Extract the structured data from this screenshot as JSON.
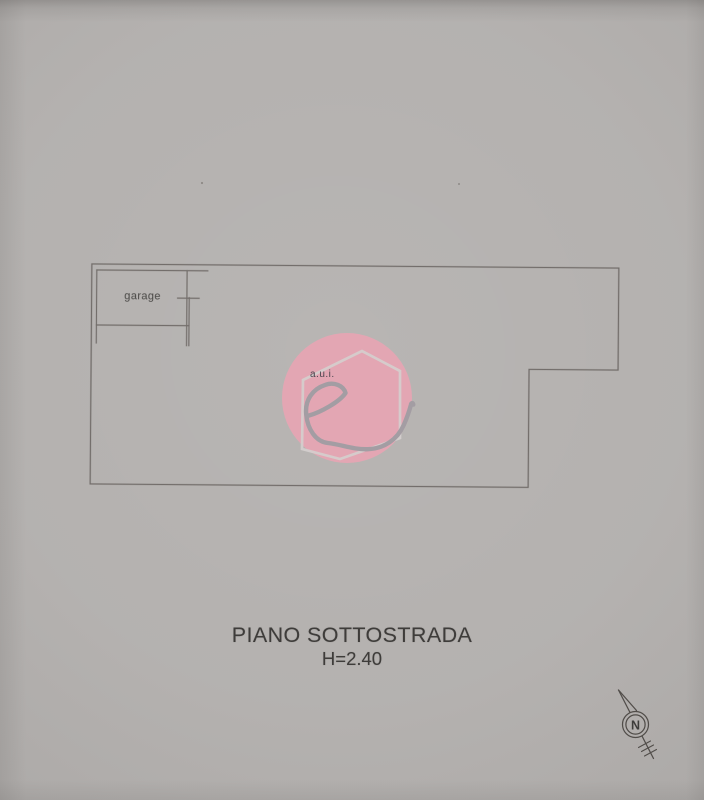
{
  "plan": {
    "caption": {
      "title": "PIANO SOTTOSTRADA",
      "height": "H=2.40"
    },
    "rooms": [
      {
        "label": "garage"
      }
    ]
  },
  "watermark": {
    "caption": "a.u.i.",
    "letter": "e"
  },
  "compass": {
    "label": "N"
  },
  "colors": {
    "paper": "#b2afad",
    "ink": "#6d6865",
    "text": "#3e3c3a",
    "watermark_pink": "#e5a6b4",
    "watermark_outline": "#d6d0cf",
    "watermark_letter": "#a39da3",
    "watermark_text": "#46414a",
    "compass_ink": "#514d4a"
  }
}
